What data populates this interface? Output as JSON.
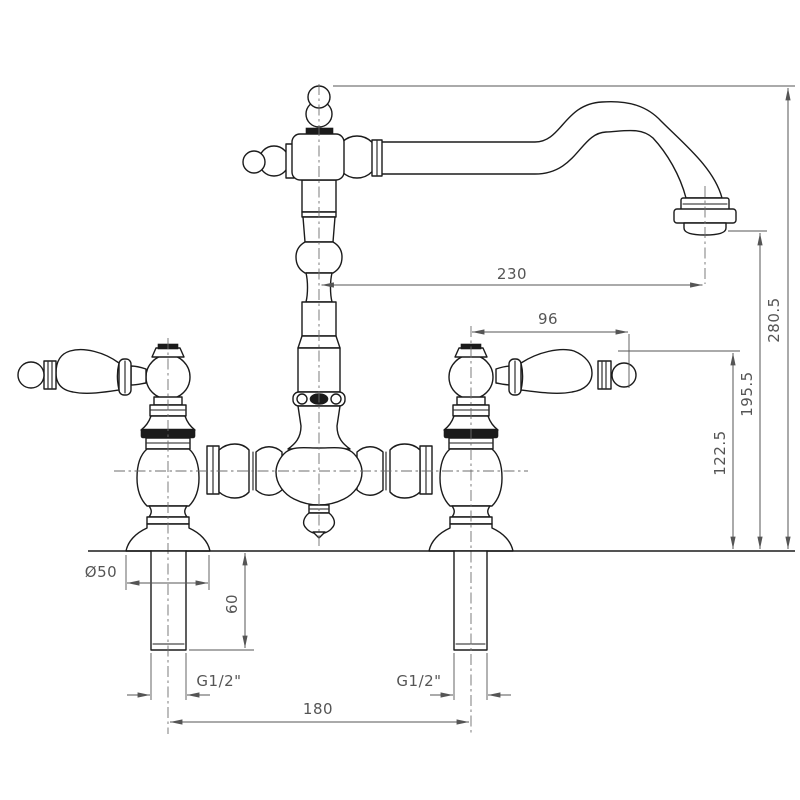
{
  "drawing": {
    "background": "#ffffff",
    "outline_color": "#1b1b1b",
    "dimension_color": "#555555",
    "dimensions": {
      "spout_reach": "230",
      "overall_height": "280.5",
      "outlet_height": "195.5",
      "handle_height": "122.5",
      "handle_length": "96",
      "flange_diameter": "Ø50",
      "shank_length": "60",
      "left_inlet_thread": "G1/2\"",
      "right_inlet_thread": "G1/2\"",
      "inlet_centres": "180"
    }
  }
}
